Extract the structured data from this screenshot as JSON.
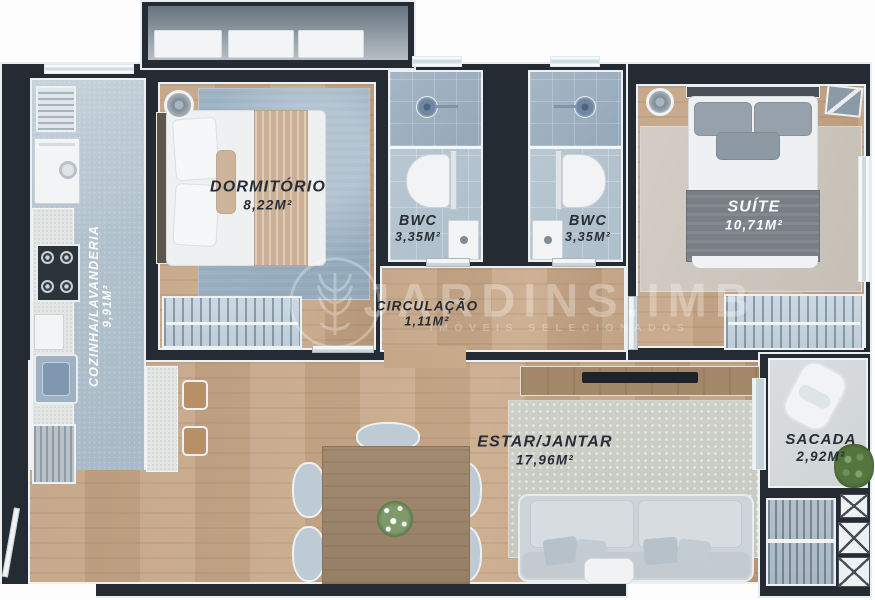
{
  "watermark": {
    "brand": "JARDINS.IMB",
    "tagline": "IMÓVEIS SELECIONADOS",
    "logo": "branch-badge-icon"
  },
  "rooms": {
    "cozinha": {
      "name": "COZINHA/LAVANDERIA",
      "area": "9,91M²"
    },
    "dormitorio": {
      "name": "DORMITÓRIO",
      "area": "8,22M²"
    },
    "bwc1": {
      "name": "BWC",
      "area": "3,35M²"
    },
    "bwc2": {
      "name": "BWC",
      "area": "3,35M²"
    },
    "suite": {
      "name": "SUÍTE",
      "area": "10,71M²"
    },
    "circulacao": {
      "name": "CIRCULAÇÃO",
      "area": "1,11M²"
    },
    "estar_jantar": {
      "name": "ESTAR/JANTAR",
      "area": "17,96M²"
    },
    "sacada": {
      "name": "SACADA",
      "area": "2,92M²"
    }
  },
  "colors": {
    "wall": "#252b32",
    "outline": "#eef1f3",
    "wood_floor": "#c3a384",
    "kitchen_tile": "#b1c1cc",
    "bath_tile": "#b4c4d0",
    "rug_dormitorio": "#9cb2c2",
    "rug_suite": "#cdc7bf",
    "rug_living": "#c9ccc4",
    "label_dark": "#272d34",
    "label_light": "#ffffff"
  }
}
